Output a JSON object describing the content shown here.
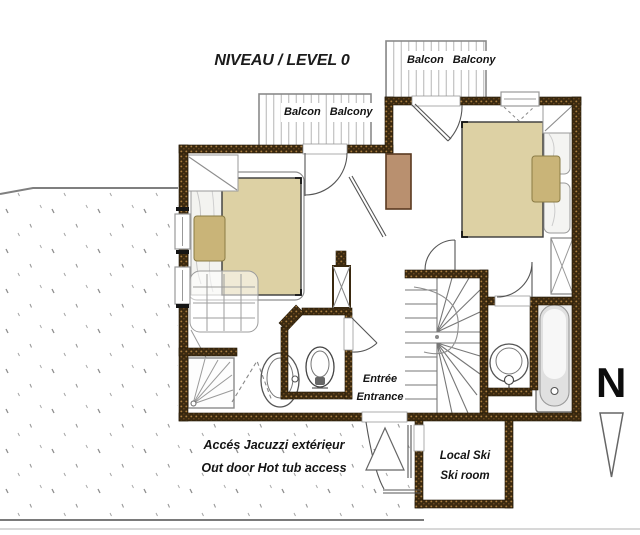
{
  "title": "NIVEAU / LEVEL 0",
  "labels": {
    "balcony_top_left": {
      "line1": "Balcon",
      "line2": "Balcony"
    },
    "balcony_top_right": {
      "line1": "Balcon",
      "line2": "Balcony"
    },
    "entrance": {
      "line1": "Entrée",
      "line2": "Entrance"
    },
    "jacuzzi_access": {
      "line1": "Accés Jacuzzi extérieur",
      "line2": "Out door Hot tub access"
    },
    "ski_room": {
      "line1": "Local Ski",
      "line2": "Ski room"
    },
    "north": "N"
  },
  "colors": {
    "wall": "#3a2910",
    "wall_speckle": "#a87c3e",
    "bed_mattress": "#ddd1a4",
    "cushion": "#c9b478",
    "chimney": "#b9906f",
    "plan_line": "#555555",
    "terrain_dot": "#8f8f8f"
  }
}
